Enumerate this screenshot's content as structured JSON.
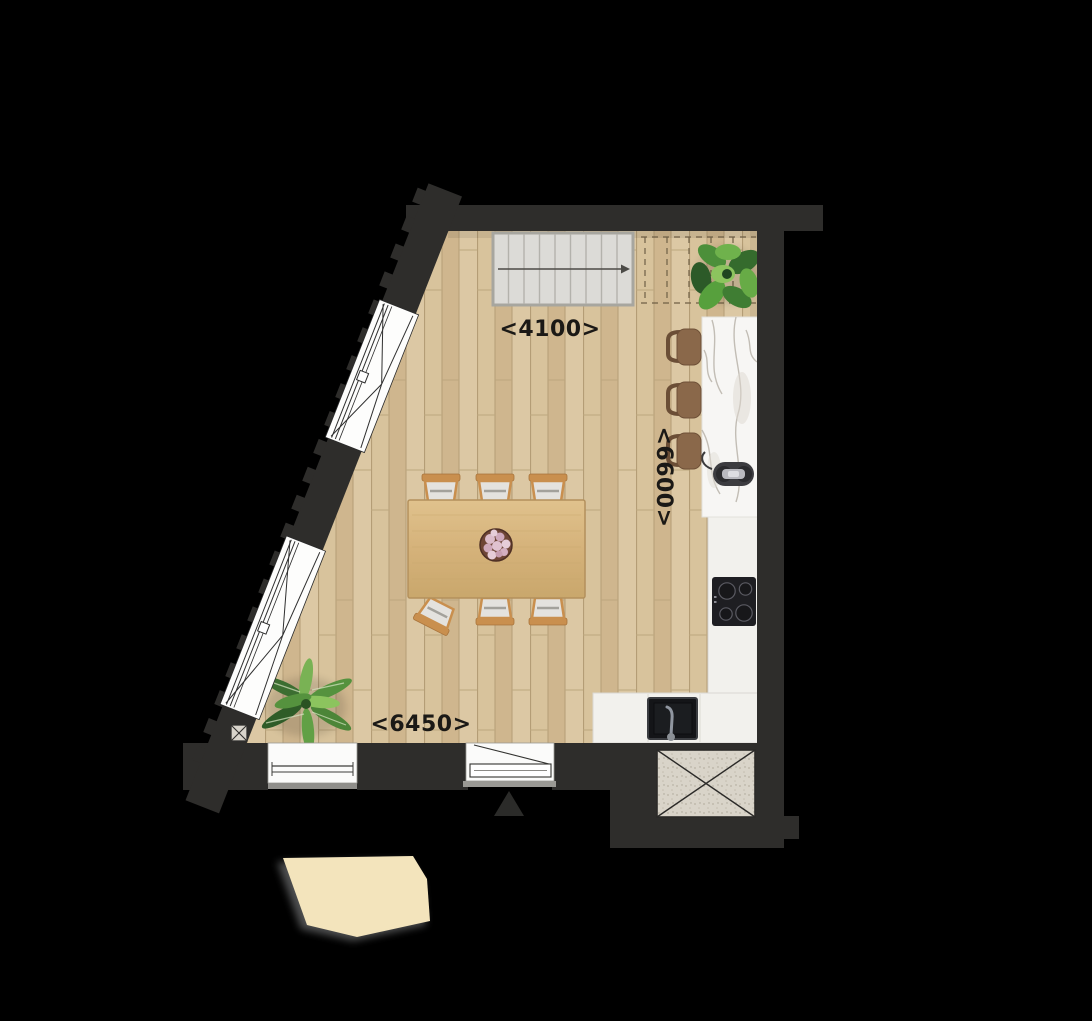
{
  "document": {
    "kind": "architectural floor plan, top view",
    "background": "#000000"
  },
  "dimensions": {
    "top": "<4100>",
    "right": "<6600>",
    "bottom": "<6450>"
  },
  "colors": {
    "wall": "#2e2d2b",
    "floor_wood": "#d7c29c",
    "floor_seam": "#b79f78",
    "stairs": "#dcdbd7",
    "counter_white": "#f2f1ed",
    "island_marble": "#f7f6f4",
    "stool_brown": "#8a684a",
    "table_wood": "#d9ba85",
    "chair_wood": "#c98f4e",
    "chair_cushion": "#e4e2de",
    "plant_green": "#4c8f3a",
    "awning_beige": "#f3e4bc",
    "appliance_black": "#1e1e22",
    "dimension_text": "#1b1916"
  },
  "elements": {
    "staircase": {
      "treads": 9,
      "walk_line": "arrow pointing right",
      "continuation": "dashed outline"
    },
    "dining_table": {
      "chairs": 6,
      "pulled_out_chairs": 1,
      "centerpiece": "flower-vase"
    },
    "kitchen_island": {
      "material": "marble",
      "bar_stools": 3,
      "fixture": "faucet"
    },
    "kitchen_counter": {
      "shape": "L",
      "appliances": [
        "cooktop",
        "sink"
      ],
      "cooktop_burners": 4
    },
    "plants": [
      "monstera",
      "dracaena"
    ],
    "windows": {
      "diagonal_facade": 2,
      "bottom_wall": 1
    },
    "entry_door": 1,
    "entry_marker": "triangle",
    "shaft": {
      "marker": "diagonal cross"
    },
    "column_marker": "small square with cross",
    "awning": "beige canopy outside, bottom-left"
  }
}
